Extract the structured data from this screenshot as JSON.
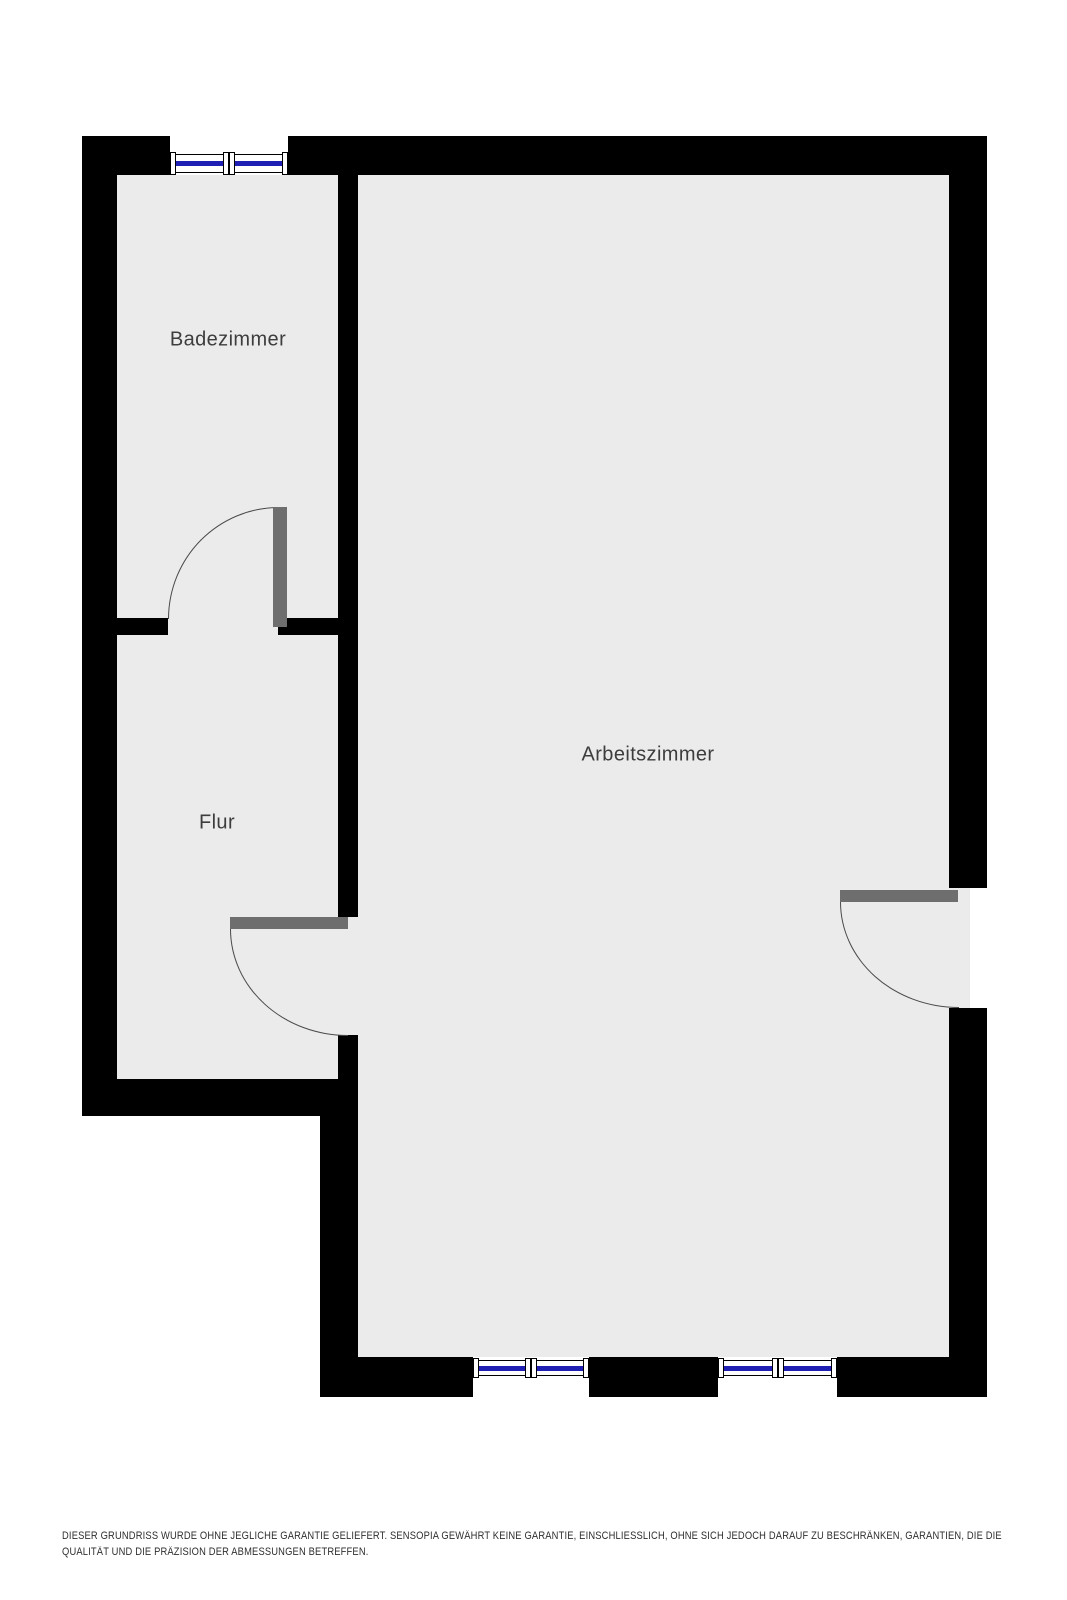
{
  "floorplan": {
    "rooms": [
      {
        "id": "badezimmer",
        "label": "Badezimmer"
      },
      {
        "id": "flur",
        "label": "Flur"
      },
      {
        "id": "arbeitszimmer",
        "label": "Arbeitszimmer"
      }
    ],
    "doors": 3,
    "windows": 3,
    "colors": {
      "wall": "#000000",
      "floor": "#ebebeb",
      "door_leaf": "#6e6e6e",
      "door_arc": "#4a4a4a",
      "window_glass_line": "#1f1fb4",
      "window_frame": "#000000",
      "outside": "#ffffff",
      "label_text": "#3d3d3d",
      "disclaimer_text": "#2e2e2e"
    }
  },
  "disclaimer": {
    "line1": "DIESER GRUNDRISS WURDE OHNE JEGLICHE GARANTIE GELIEFERT. SENSOPIA GEWÄHRT KEINE GARANTIE, EINSCHLIESSLICH, OHNE SICH JEDOCH DARAUF ZU BESCHRÄNKEN, GARANTIEN, DIE DIE",
    "line2": "QUALITÄT UND DIE PRÄZISION DER ABMESSUNGEN BETREFFEN."
  }
}
